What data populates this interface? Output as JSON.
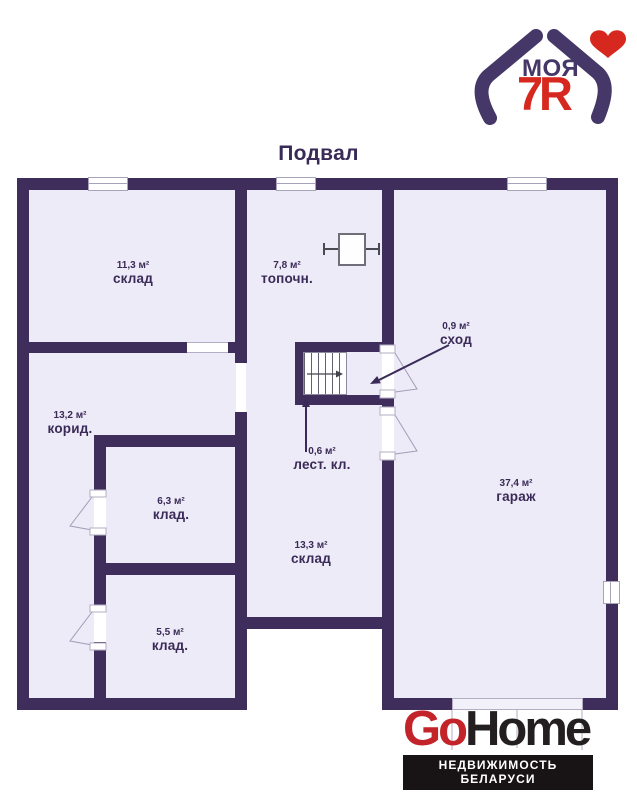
{
  "title": "Подвал",
  "top_logo": {
    "word": "МОЯ",
    "digit": "7",
    "letter": "Я"
  },
  "rooms": [
    {
      "name": "склад",
      "area": "11,3 м²"
    },
    {
      "name": "топочн.",
      "area": "7,8 м²"
    },
    {
      "name": "корид.",
      "area": "13,2 м²"
    },
    {
      "name": "клад.",
      "area": "6,3 м²"
    },
    {
      "name": "клад.",
      "area": "5,5 м²"
    },
    {
      "name": "склад",
      "area": "13,3 м²"
    },
    {
      "name": "гараж",
      "area": "37,4 м²"
    },
    {
      "name": "сход",
      "area": "0,9 м²"
    },
    {
      "name": "лест. кл.",
      "area": "0,6 м²"
    }
  ],
  "icons": {
    "boiler": "furnace-square-symbol",
    "stairs": "staircase-with-direction-arrow",
    "heart": "red-heart",
    "house": "house-of-two-arms"
  },
  "footer": {
    "brand_red": "Go",
    "brand_dark": "Home",
    "tagline": "НЕДВИЖИМОСТЬ БЕЛАРУСИ"
  },
  "colors": {
    "wall": "#3f2e5b",
    "room_fill": "#edebf7",
    "label_text": "#3a2a57",
    "brand_indigo": "#453767",
    "brand_red": "#d6281e",
    "footer_red": "#c2242a",
    "footer_dark": "#231f20"
  }
}
